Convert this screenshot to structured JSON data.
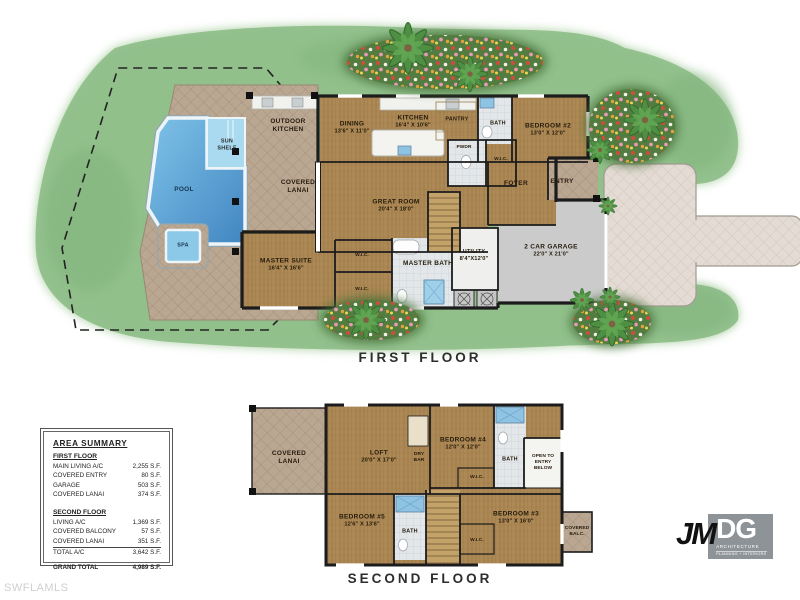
{
  "watermark": "SWFLAMLS",
  "logo": {
    "jm": "JM",
    "dg": "DG",
    "sub1": "ARCHITECTURE",
    "sub2": "PLANNING + INTERIORS"
  },
  "first_floor": {
    "title": "FIRST FLOOR",
    "rooms": {
      "outdoor_kitchen": {
        "name": "OUTDOOR KITCHEN"
      },
      "dining": {
        "name": "DINING",
        "dims": "13'6\" X 11'0\""
      },
      "kitchen": {
        "name": "KITCHEN",
        "dims": "16'4\" X 10'6\""
      },
      "pantry": {
        "name": "PANTRY"
      },
      "bath": {
        "name": "BATH"
      },
      "bedroom2": {
        "name": "BEDROOM #2",
        "dims": "13'0\" X 12'0\""
      },
      "pwdr": {
        "name": "PWDR"
      },
      "wic_bed2": {
        "name": "W.I.C."
      },
      "foyer": {
        "name": "FOYER"
      },
      "entry": {
        "name": "ENTRY"
      },
      "covered_lanai": {
        "name": "COVERED LANAI"
      },
      "great_room": {
        "name": "GREAT ROOM",
        "dims": "20'4\" X 18'0\""
      },
      "master_suite": {
        "name": "MASTER SUITE",
        "dims": "16'4\" X 16'6\""
      },
      "wic1": {
        "name": "W.I.C."
      },
      "wic2": {
        "name": "W.I.C."
      },
      "master_bath": {
        "name": "MASTER BATH"
      },
      "utility": {
        "name": "UTILITY",
        "dims": "8'4\"X12'0\""
      },
      "garage": {
        "name": "2 CAR GARAGE",
        "dims": "22'0\" X 21'0\""
      },
      "pool": {
        "name": "POOL"
      },
      "spa": {
        "name": "SPA"
      },
      "sun_shelf": {
        "name": "SUN SHELF"
      }
    }
  },
  "second_floor": {
    "title": "SECOND FLOOR",
    "rooms": {
      "covered_lanai": {
        "name": "COVERED LANAI"
      },
      "loft": {
        "name": "LOFT",
        "dims": "20'0\" X 17'0\""
      },
      "dry_bar": {
        "name": "DRY BAR"
      },
      "bedroom4": {
        "name": "BEDROOM #4",
        "dims": "12'0\" X 12'0\""
      },
      "bath_upper": {
        "name": "BATH"
      },
      "open_to_entry": {
        "name": "OPEN TO ENTRY BELOW"
      },
      "wic_upper": {
        "name": "W.I.C."
      },
      "bedroom5": {
        "name": "BEDROOM #5",
        "dims": "12'6\" X 13'6\""
      },
      "bath_lower": {
        "name": "BATH"
      },
      "wic_lower": {
        "name": "W.I.C."
      },
      "bedroom3": {
        "name": "BEDROOM #3",
        "dims": "13'0\" X 16'0\""
      },
      "covered_balc": {
        "name": "COVERED BALC."
      }
    }
  },
  "area_summary": {
    "title": "AREA SUMMARY",
    "first_floor_heading": "FIRST FLOOR",
    "ff_rows": [
      {
        "label": "MAIN LIVING A/C",
        "value": "2,255 S.F."
      },
      {
        "label": "COVERED ENTRY",
        "value": "80 S.F."
      },
      {
        "label": "GARAGE",
        "value": "503 S.F."
      },
      {
        "label": "COVERED LANAI",
        "value": "374 S.F."
      }
    ],
    "second_floor_heading": "SECOND FLOOR",
    "sf_rows": [
      {
        "label": "LIVING A/C",
        "value": "1,369 S.F."
      },
      {
        "label": "COVERED BALCONY",
        "value": "57 S.F."
      },
      {
        "label": "COVERED LANAI",
        "value": "351 S.F."
      },
      {
        "label": "TOTAL A/C",
        "value": "3,642 S.F."
      }
    ],
    "grand_total_label": "GRAND TOTAL",
    "grand_total_value": "4,989 S.F."
  },
  "colors": {
    "lawn": "#8fbe8a",
    "paver_deck": "#baa792",
    "driveway": "#e4dbd4",
    "wood_floor": "#ad8a55",
    "tile": "#e3e7e9",
    "pool_water": "#4286c2",
    "garage_floor": "#cbcbcb",
    "wall": "#1c1c1c",
    "flower_bed": "#527c40",
    "palm": "#4f8f44",
    "logo_gray": "#8e9397"
  }
}
